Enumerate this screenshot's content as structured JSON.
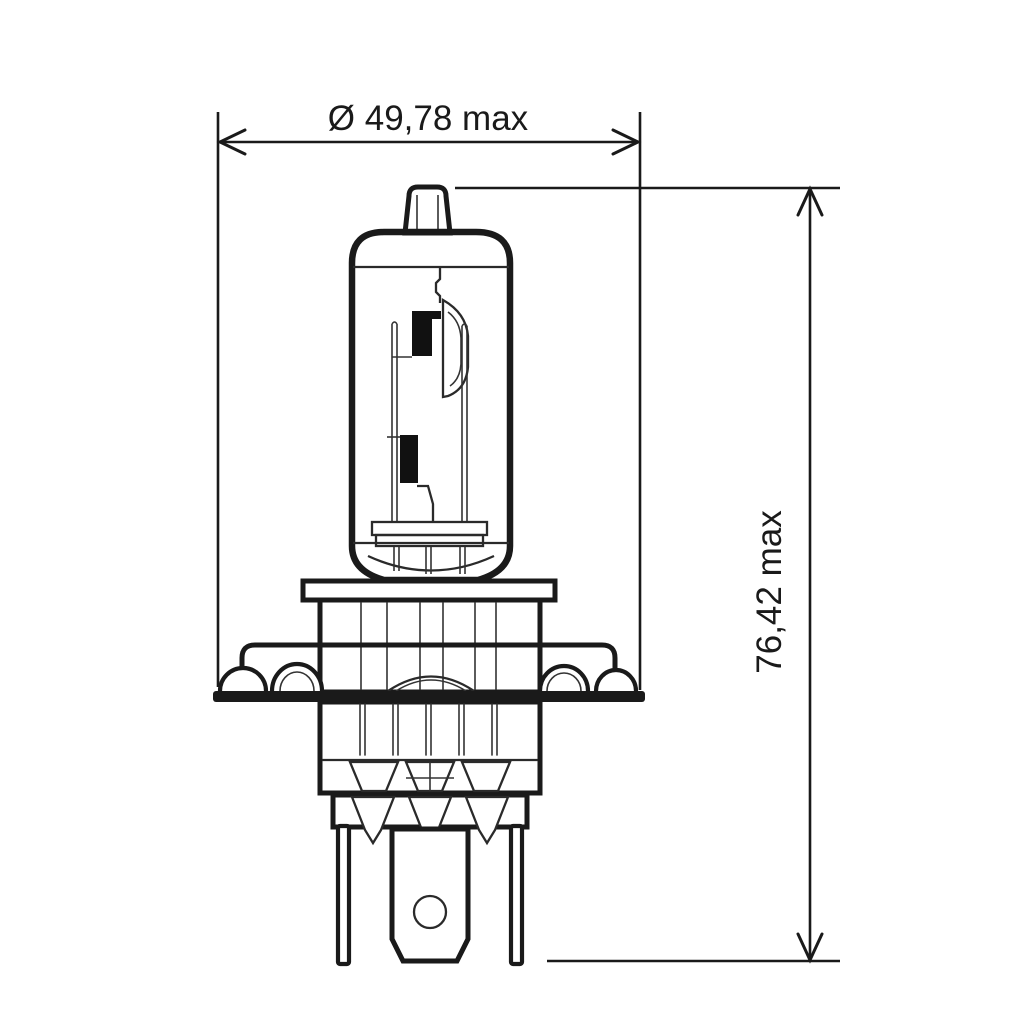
{
  "diagram": {
    "dimensions": {
      "diameter_label": "Ø 49,78 max",
      "height_label": "76,42 max"
    },
    "colors": {
      "line": "#1a1a1a",
      "glass_fill": "#e4e4e4",
      "inner_fill": "#ededed",
      "shield_fill": "#111111"
    }
  }
}
